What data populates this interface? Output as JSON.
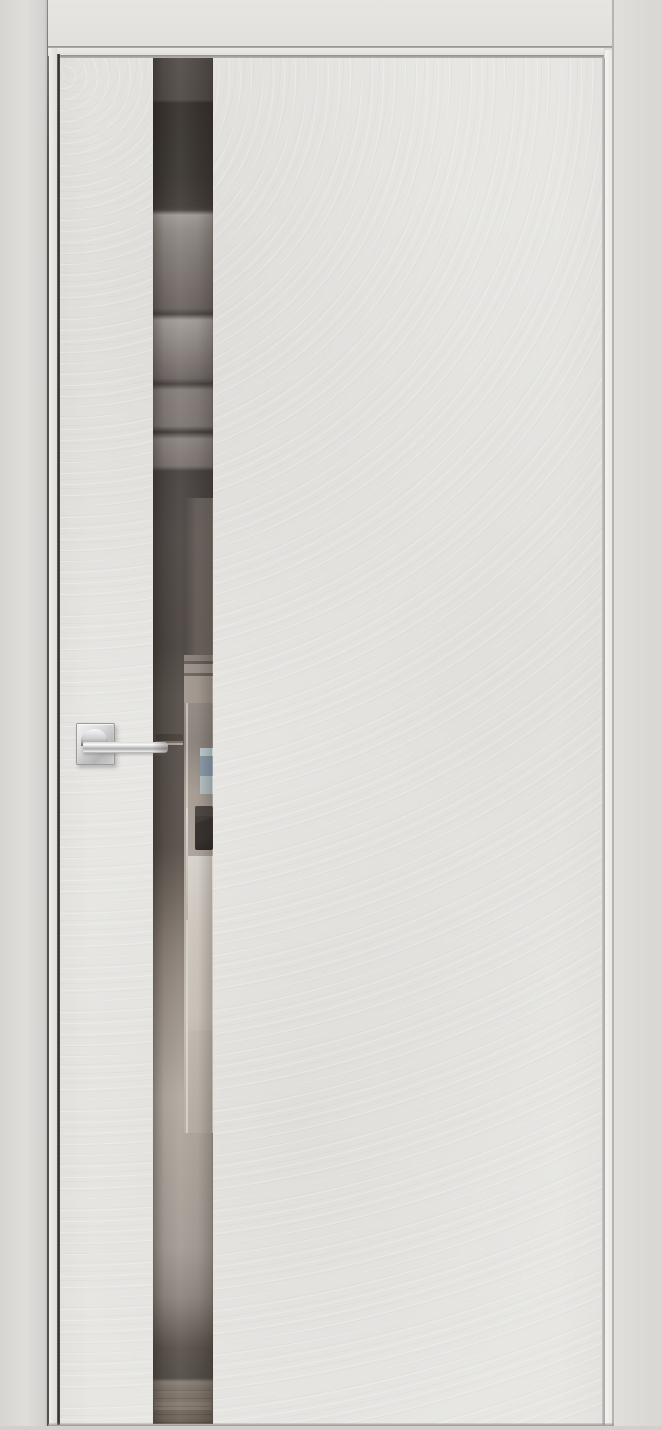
{
  "meta": {
    "type": "product-photograph",
    "description": "Closed modern interior door with light grey concrete-textured slab, full-height smoked mirror insert strip and chrome lever handle, set in a matching grey frame; the mirror reflects a room interior (ceiling panels, open doorway, window, dark sofa, wooden floor)."
  },
  "labels": {
    "scene": "Interior door product photo",
    "casing_left": "Left frame casing",
    "casing_top": "Top frame casing",
    "casing_right": "Right frame casing",
    "jamb": "Door frame jamb",
    "door": "Door slab with concrete texture finish",
    "mirror": "Full-height smoked mirror insert",
    "mirror_ceiling": "Reflection of ceiling panels",
    "mirror_doorway": "Reflection of open doorway",
    "mirror_window": "Reflection of window",
    "mirror_sofa": "Reflection of dark sofa",
    "mirror_handle": "Reflection of door handle",
    "mirror_wood_floor": "Reflection of wooden floor",
    "handle": "Chrome lever door handle",
    "rosette": "Square chrome rosette",
    "lever": "Chrome lever arm",
    "floor": "Floor line below door"
  },
  "colors": {
    "scene-bg": "#dcdbd8",
    "casing": "#dedddb",
    "casing-dark": "#d6d5d2",
    "jamb": "#eeedea",
    "door": "#e7e6e3",
    "gap-line": "#2b2a28",
    "soft-line": "#9b9995",
    "mirror-dark": "#38322e",
    "mirror-mid": "#7b736f",
    "mirror-light": "#b0a9a0",
    "wood": "#7d7269",
    "doorway": "#b4aba2",
    "window-blue": "#8e9dac",
    "sofa": "#393330",
    "chrome-hi": "#fbfbfb",
    "chrome-lo": "#9c9c9c",
    "handle-refl": "#463f3a",
    "floor": "#d2d0cd"
  }
}
